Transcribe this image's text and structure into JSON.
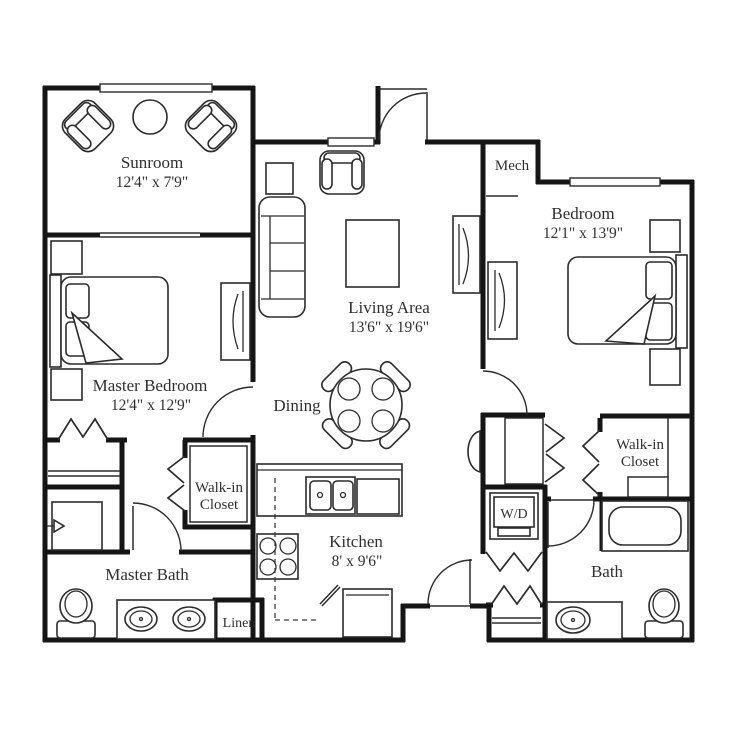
{
  "document": {
    "type": "apartment-floor-plan"
  },
  "colors": {
    "wall": "#151515",
    "line": "#2b2b2b",
    "text": "#2f2f2f",
    "background": "#ffffff"
  },
  "rooms": {
    "sunroom": {
      "name": "Sunroom",
      "dims": "12'4\" x 7'9\""
    },
    "master_bedroom": {
      "name": "Master Bedroom",
      "dims": "12'4\" x 12'9\""
    },
    "living": {
      "name": "Living Area",
      "dims": "13'6\" x 19'6\""
    },
    "dining": {
      "name": "Dining"
    },
    "kitchen": {
      "name": "Kitchen",
      "dims": "8' x 9'6\""
    },
    "bedroom": {
      "name": "Bedroom",
      "dims": "12'1\" x 13'9\""
    },
    "mech": {
      "name": "Mech"
    },
    "master_closet": {
      "line1": "Walk-in",
      "line2": "Closet"
    },
    "bedroom_closet": {
      "line1": "Walk-in",
      "line2": "Closet"
    },
    "master_bath": {
      "name": "Master Bath"
    },
    "bath": {
      "name": "Bath"
    },
    "linen": {
      "name": "Linen"
    },
    "laundry": {
      "name": "W/D"
    }
  }
}
